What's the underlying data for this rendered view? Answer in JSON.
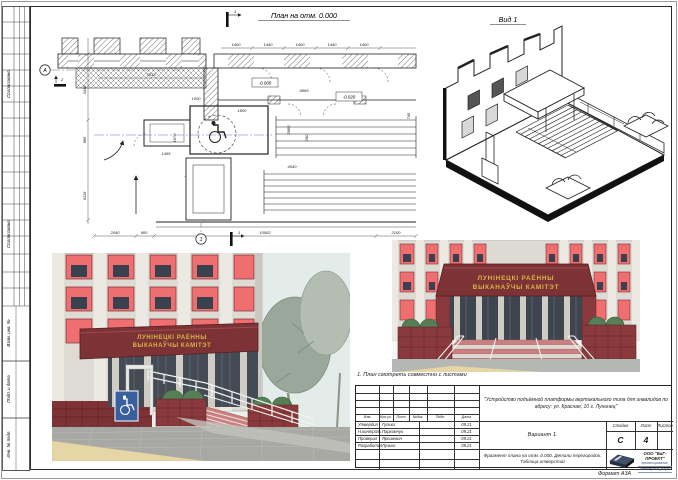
{
  "frame": {
    "format_label": "Формат А3А",
    "note": "1. План смотреть совместно с листами"
  },
  "side_column": {
    "blocks": [
      "Согласовано",
      "Согласовано"
    ],
    "labels": [
      "Взам. инв. №",
      "Подп. и дата",
      "Инв. № подл."
    ]
  },
  "plan": {
    "title": "План на отм. 0.000",
    "axis_a": "А",
    "axis_1": "1",
    "flag_top": "1",
    "flag_left": "2",
    "flag_bottom": "1",
    "dims": {
      "b1": "2040",
      "b2": "900",
      "b3": "10582",
      "b4": "2100",
      "t1": "1400",
      "t2": "1440",
      "t3": "1400",
      "t4": "1440",
      "t5": "1400",
      "l1": "3418",
      "l2": "985",
      "l3": "6115",
      "i1": "7013",
      "i2": "1800",
      "i3": "6869",
      "i4": "1000",
      "i5": "2880",
      "i6": "290",
      "i7": "4540",
      "i9": "1070",
      "i10": "745",
      "i12": "1495",
      "e1": "-0.000",
      "e2": "-0.020",
      "e3": "-0.640"
    }
  },
  "view1": {
    "title": "Вид 1"
  },
  "renders": {
    "sign_line1": "ЛУНІНЕЦКІ РАЁННЫ",
    "sign_line2": "ВЫКАНАЎЧЫ КАМІТЭТ"
  },
  "titleblock": {
    "doc_title": "\"Устройство подъёмной платформы вертикального типа для инвалидов по адресу: ул. Красная, 10 г. Лунинец\"",
    "variant": "Вариант 1.",
    "sheet_title": "Фрагмент плана на отм. 0.000. Детали перегородок. Таблица отверстий",
    "header": [
      "Изм.",
      "Кол.уч.",
      "Лист",
      "№док.",
      "Подп.",
      "Дата"
    ],
    "rows": [
      {
        "role": "Утвердил",
        "name": "Гулько",
        "date": "09.21"
      },
      {
        "role": "Н.контроль",
        "name": "Пархомчук",
        "date": "09.21"
      },
      {
        "role": "Проверил",
        "name": "Ярошевич",
        "date": "09.21"
      },
      {
        "role": "Разработал",
        "name": "Лузько",
        "date": "09.21"
      }
    ],
    "stage_label": "Стадия",
    "sheet_label": "Лист",
    "sheets_label": "Листов",
    "stage": "С",
    "sheet_num": "4",
    "company": "ООО \"БиГ-ПРОЕКТ\"",
    "company_sub1": "проектирование,",
    "company_sub2": "инженерные услуги"
  },
  "colors": {
    "canopy": "#7d3336",
    "window": "#ef6f70",
    "gold": "#d9b544",
    "sign_blue": "#3a5f9e",
    "shrub": "#577f57",
    "pavement": "#a8a8a5",
    "path_tan": "#e6d6a6"
  }
}
